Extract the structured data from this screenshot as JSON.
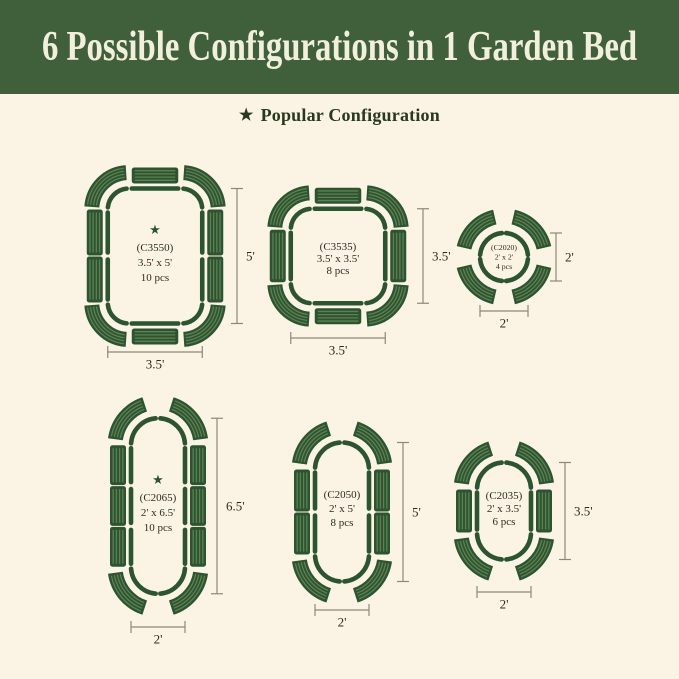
{
  "header": {
    "title": "6 Possible Configurations in 1 Garden Bed"
  },
  "legend": {
    "star": "★",
    "label": "Popular Configuration"
  },
  "colors": {
    "background": "#FBF4E4",
    "header_bg": "#40603B",
    "header_text": "#F2EFDC",
    "green_dark": "#2D5431",
    "green_stripe": "#5E8053",
    "dim_line": "#8D8876",
    "label_text": "#2A2D22"
  },
  "configs": [
    {
      "id": "C3550",
      "code_label": "(C3550)",
      "size_label": "3.5' x 5'",
      "pcs_label": "10 pcs",
      "popular": true,
      "star": "★",
      "height_dim_label": "5'",
      "width_dim_label": "3.5'"
    },
    {
      "id": "C3535",
      "code_label": "(C3535)",
      "size_label": "3.5' x 3.5'",
      "pcs_label": "8 pcs",
      "popular": false,
      "height_dim_label": "3.5'",
      "width_dim_label": "3.5'"
    },
    {
      "id": "C2020",
      "code_label": "(C2020)",
      "size_label": "2' x 2'",
      "pcs_label": "4 pcs",
      "popular": false,
      "height_dim_label": "2'",
      "width_dim_label": "2'"
    },
    {
      "id": "C2065",
      "code_label": "(C2065)",
      "size_label": "2' x 6.5'",
      "pcs_label": "10 pcs",
      "popular": true,
      "star": "★",
      "height_dim_label": "6.5'",
      "width_dim_label": "2'"
    },
    {
      "id": "C2050",
      "code_label": "(C2050)",
      "size_label": "2' x 5'",
      "pcs_label": "8 pcs",
      "popular": false,
      "height_dim_label": "5'",
      "width_dim_label": "2'"
    },
    {
      "id": "C2035",
      "code_label": "(C2035)",
      "size_label": "2' x 3.5'",
      "pcs_label": "6 pcs",
      "popular": false,
      "height_dim_label": "3.5'",
      "width_dim_label": "2'"
    }
  ]
}
